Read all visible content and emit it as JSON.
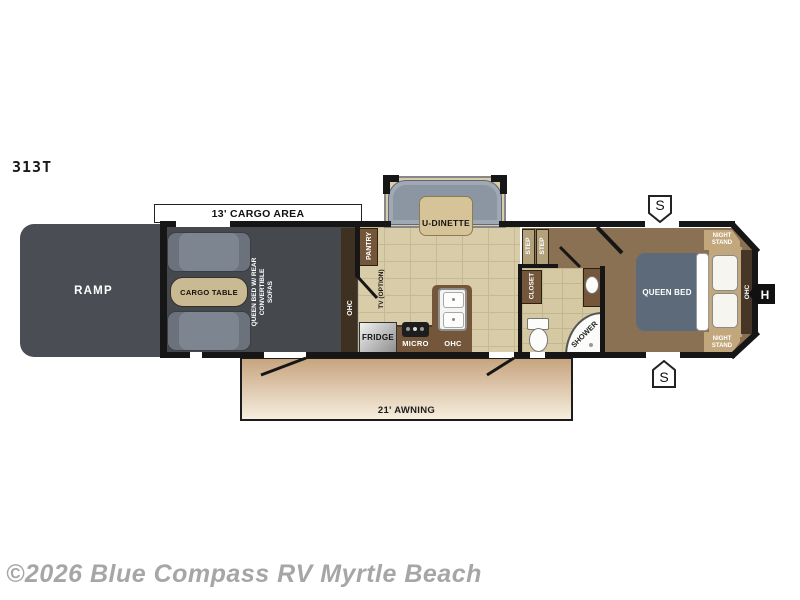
{
  "model": "313T",
  "watermark": "©2026 Blue Compass RV Myrtle Beach",
  "colors": {
    "wall": "#161616",
    "cargo_floor": "#45494e",
    "ramp": "#4a4e54",
    "sofa_gray": "#7d8590",
    "table_tan": "#c9ba94",
    "main_floor_tan": "#d9cda9",
    "grout": "#c6ba92",
    "cabinet_brown": "#74573a",
    "dark_cabinet_brown": "#3e3122",
    "bedroom_floor": "#8a7153",
    "bed_blue": "#5d6a79",
    "dinette_sofa_gray": "#8c96a3",
    "awning_top": "#c7a47f",
    "awning_bottom": "#f6eede",
    "watermark_gray": "#a6a6a8"
  },
  "floorplan": {
    "cargo_bracket_label": "13' CARGO AREA",
    "ramp_label": "RAMP",
    "cargo_table_label": "CARGO TABLE",
    "convertible_note": "QUEEN BED W/ REAR CONVERTIBLE SOFAS",
    "ohc_rear": "OHC",
    "pantry": "PANTRY",
    "tv_option": "TV (OPTION)",
    "fridge": "FRIDGE",
    "micro": "MICRO",
    "ohc_kitchen": "OHC",
    "u_dinette": "U-DINETTE",
    "step_1": "STEP",
    "step_2": "STEP",
    "closet": "CLOSET",
    "shower": "SHOWER",
    "queen_bed": "QUEEN BED",
    "ohc_bedroom": "OHC",
    "night_stand_top": "NIGHT STAND",
    "night_stand_bottom": "NIGHT STAND",
    "awning_label": "21' AWNING",
    "marker_speaker_top": "S",
    "marker_speaker_bottom": "S",
    "marker_hitch": "H"
  }
}
